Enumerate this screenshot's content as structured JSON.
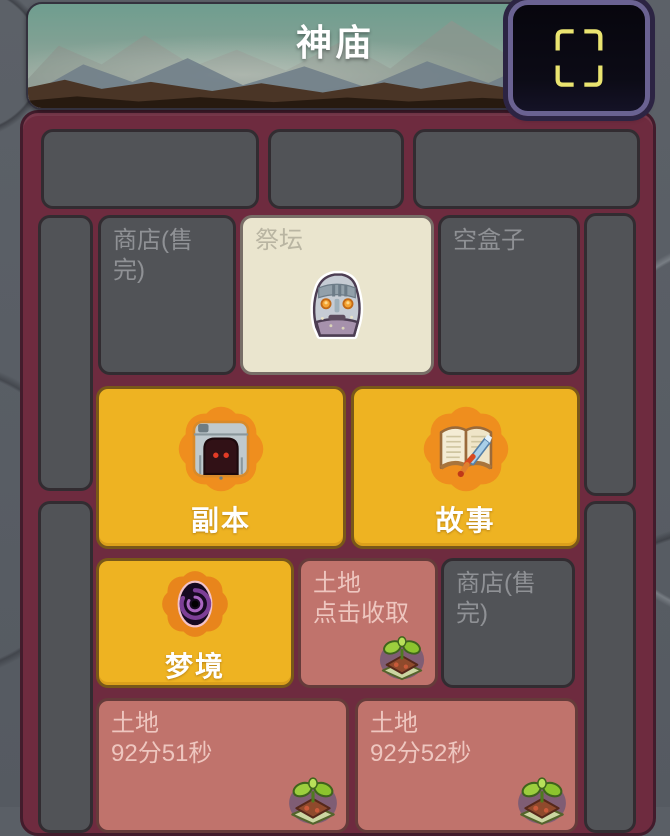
{
  "header": {
    "title": "神庙"
  },
  "fullscreen_button": {
    "icon": "frame-brackets-icon"
  },
  "tiles": {
    "shop_top": {
      "label": "商店(售完)"
    },
    "altar": {
      "label": "祭坛",
      "icon": "statue-icon"
    },
    "empty_box": {
      "label": "空盒子"
    },
    "dungeon": {
      "label": "副本",
      "icon": "cave-icon"
    },
    "story": {
      "label": "故事",
      "icon": "book-sword-icon"
    },
    "dream": {
      "label": "梦境",
      "icon": "vortex-icon"
    },
    "land_ready": {
      "label": "土地",
      "sublabel": "点击收取",
      "icon": "sprout-icon"
    },
    "shop_mid": {
      "label": "商店(售完)"
    },
    "land_timer_1": {
      "label": "土地",
      "timer": "92分51秒",
      "icon": "sprout-icon"
    },
    "land_timer_2": {
      "label": "土地",
      "timer": "92分52秒",
      "icon": "sprout-icon"
    }
  },
  "colors": {
    "accent_gold": "#eeb322",
    "panel_maroon": "#6e2b3f",
    "tile_dark": "#515357",
    "tile_cream": "#eae5ce",
    "tile_red": "#c0736c",
    "starburst_orange": "#ef8e1e",
    "button_border_purple": "#6a6292",
    "bracket_yellow": "#eae470",
    "title_white": "#ffffff"
  }
}
